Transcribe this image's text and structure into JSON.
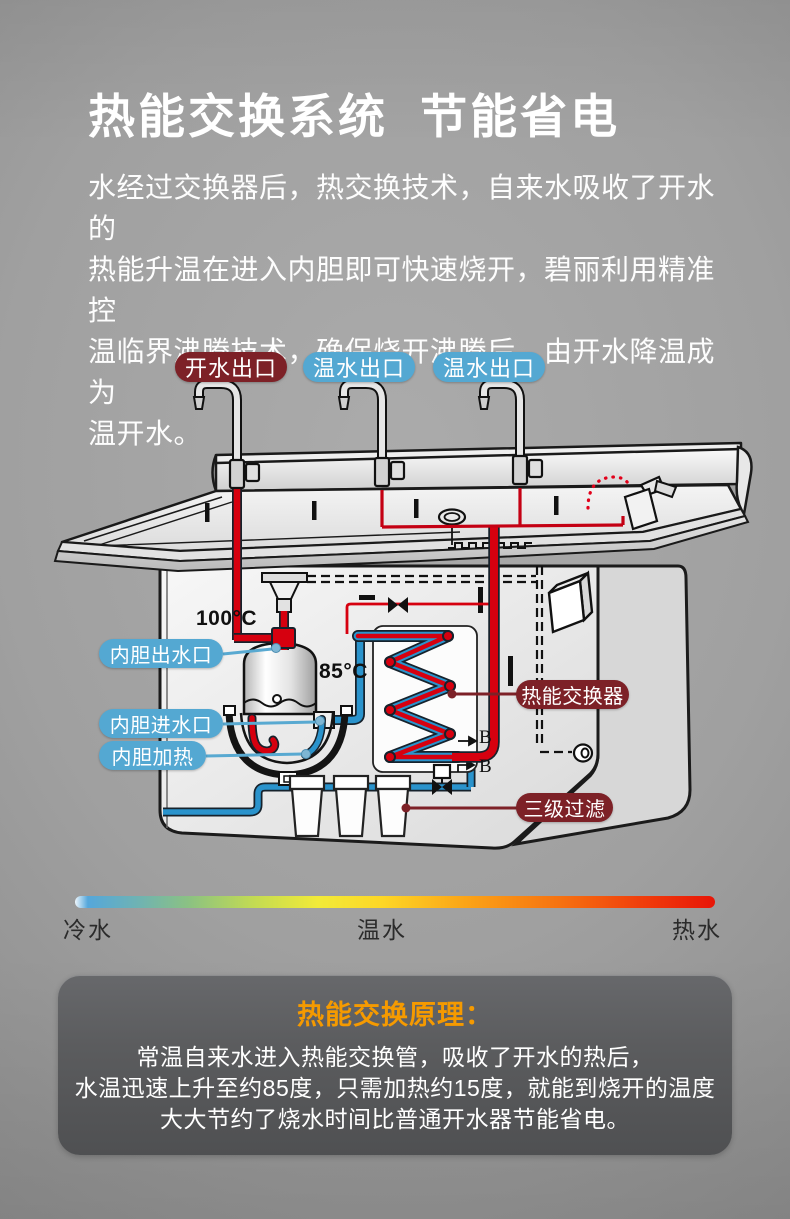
{
  "header": {
    "title": "热能交换系统  节能省电"
  },
  "intro": {
    "lines": [
      "水经过交换器后，热交换技术，自来水吸收了开水的",
      "热能升温在进入内胆即可快速烧开，碧丽利用精准控",
      "温临界沸腾技术，确保烧开沸腾后，由开水降温成为",
      "温开水。"
    ]
  },
  "diagram": {
    "faucet_labels": [
      {
        "text": "开水出口",
        "type": "hot"
      },
      {
        "text": "温水出口",
        "type": "warm"
      },
      {
        "text": "温水出口",
        "type": "warm"
      }
    ],
    "temps": {
      "boiler": "100°C",
      "exchanger_out": "85°C"
    },
    "part_labels": {
      "tank_outlet": "内胆出水口",
      "tank_inlet": "内胆进水口",
      "tank_heater": "内胆加热",
      "heat_exchanger": "热能交换器",
      "filter": "三级过滤"
    },
    "connector_marks": {
      "b1": "B",
      "b2": "B"
    }
  },
  "scale": {
    "cold": "冷水",
    "warm": "温水",
    "hot": "热水"
  },
  "principle": {
    "title": "热能交换原理：",
    "lines": [
      "常温自来水进入热能交换管，吸收了开水的热后，",
      "水温迅速上升至约85度，只需加热约15度，就能到烧开的温度",
      "大大节约了烧水时间比普通开水器节能省电。"
    ]
  },
  "colors": {
    "hot_pipe": "#d6000f",
    "cold_pipe": "#2a93cc",
    "label_blue": "#54a8d2",
    "label_maroon": "#7d2127",
    "accent_orange": "#f59a00"
  }
}
